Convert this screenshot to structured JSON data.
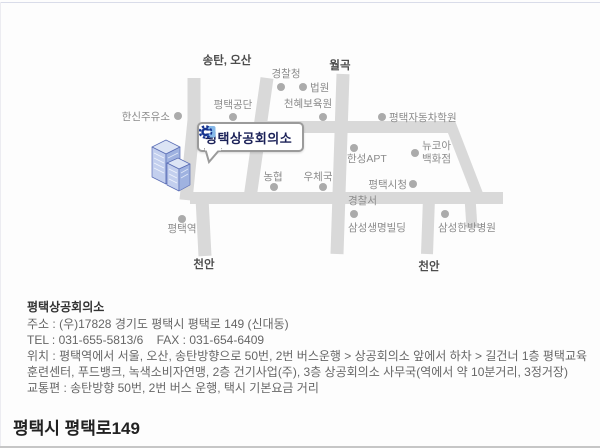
{
  "page": {
    "bottom_heading": "평택시 평택로149"
  },
  "map": {
    "callout_label": "평택상공회의소",
    "colors": {
      "road": "#d9d9d9",
      "dot": "#ababab",
      "place_label": "#8b8b8b",
      "direction_label": "#4d4d4d",
      "logo_navy": "#16338f",
      "logo_light_blue": "#85b8e8",
      "building_blue": "#9fb2e0"
    },
    "roads": [
      {
        "x1": 194,
        "y1": 78,
        "x2": 194,
        "y2": 122,
        "w": 13
      },
      {
        "x1": 194,
        "y1": 120,
        "x2": 186,
        "y2": 200,
        "w": 13
      },
      {
        "x1": 202,
        "y1": 198,
        "x2": 205,
        "y2": 256,
        "w": 13
      },
      {
        "x1": 267,
        "y1": 78,
        "x2": 250,
        "y2": 198,
        "w": 13
      },
      {
        "x1": 343,
        "y1": 74,
        "x2": 337,
        "y2": 254,
        "w": 13
      },
      {
        "x1": 256,
        "y1": 127,
        "x2": 452,
        "y2": 127,
        "w": 12
      },
      {
        "x1": 450,
        "y1": 123,
        "x2": 479,
        "y2": 198,
        "w": 11
      },
      {
        "x1": 470,
        "y1": 198,
        "x2": 472,
        "y2": 228,
        "w": 11
      },
      {
        "x1": 190,
        "y1": 198,
        "x2": 503,
        "y2": 198,
        "w": 12
      },
      {
        "x1": 429,
        "y1": 198,
        "x2": 427,
        "y2": 254,
        "w": 12
      }
    ],
    "places": [
      {
        "name": "hanshin-gas-station",
        "label": "한신주유소",
        "dot": [
          178,
          116
        ],
        "tx": 170,
        "ty": 120,
        "anchor": "end"
      },
      {
        "name": "pyeongtaek-industrial-complex",
        "label": "평택공단",
        "dot": [
          233,
          117
        ],
        "tx": 233,
        "ty": 108,
        "anchor": "middle"
      },
      {
        "name": "police-agency",
        "label": "경찰청",
        "dot": [
          281,
          87
        ],
        "tx": 286,
        "ty": 77,
        "anchor": "middle"
      },
      {
        "name": "court",
        "label": "법원",
        "dot": [
          303,
          87
        ],
        "tx": 310,
        "ty": 91,
        "anchor": "start"
      },
      {
        "name": "cheonhye-nursery",
        "label": "천혜보육원",
        "dot": [
          323,
          117
        ],
        "tx": 308,
        "ty": 107,
        "anchor": "middle"
      },
      {
        "name": "pyeongtaek-driving-school",
        "label": "평택자동차학원",
        "dot": [
          382,
          117
        ],
        "tx": 389,
        "ty": 121,
        "anchor": "start"
      },
      {
        "name": "newcore-department-store",
        "lines": [
          "뉴코아",
          "백화점"
        ],
        "dot": [
          415,
          153
        ],
        "tx": 422,
        "ty": 149,
        "anchor": "start"
      },
      {
        "name": "hanseong-apt",
        "label": "한성APT",
        "dot": [
          354,
          148
        ],
        "tx": 347,
        "ty": 162,
        "anchor": "start"
      },
      {
        "name": "pyeongtaek-city-hall",
        "label": "평택시청",
        "dot": [
          413,
          184
        ],
        "tx": 407,
        "ty": 188,
        "anchor": "end"
      },
      {
        "name": "nonghyup",
        "label": "농협",
        "dot": [
          274,
          187
        ],
        "tx": 273,
        "ty": 180,
        "anchor": "middle"
      },
      {
        "name": "post-office",
        "label": "우체국",
        "dot": [
          323,
          187
        ],
        "tx": 318,
        "ty": 180,
        "anchor": "middle"
      },
      {
        "name": "police-station",
        "label": "경찰서",
        "dot": null,
        "tx": 348,
        "ty": 204,
        "anchor": "start"
      },
      {
        "name": "samsung-life-building",
        "label": "삼성생명빌딩",
        "dot": [
          354,
          214
        ],
        "tx": 348,
        "ty": 231,
        "anchor": "start"
      },
      {
        "name": "samsung-oriental-hospital",
        "label": "삼성한방병원",
        "dot": [
          445,
          214
        ],
        "tx": 438,
        "ty": 231,
        "anchor": "start"
      },
      {
        "name": "pyeongtaek-station",
        "label": "평택역",
        "dot": [
          182,
          219
        ],
        "tx": 182,
        "ty": 232,
        "anchor": "middle"
      }
    ],
    "direction_labels": [
      {
        "name": "songtan-osan",
        "label": "송탄, 오산",
        "x": 227,
        "y": 64
      },
      {
        "name": "wolgok",
        "label": "월곡",
        "x": 340,
        "y": 69
      },
      {
        "name": "cheonan-left",
        "label": "천안",
        "x": 204,
        "y": 268
      },
      {
        "name": "cheonan-right",
        "label": "천안",
        "x": 429,
        "y": 270
      }
    ]
  },
  "info": {
    "title": "평택상공회의소",
    "lines": [
      "주소 : (우)17828 경기도 평택시 평택로 149 (신대동)",
      "TEL : 031-655-5813/6    FAX : 031-654-6409",
      "위치 : 평택역에서 서울, 오산, 송탄방향으로 50번, 2번 버스운행 > 상공회의소 앞에서 하차 > 길건너 1층 평택교육훈련센터, 푸드뱅크, 녹색소비자연맹, 2층 건기사업(주), 3층 상공회의소 사무국(역에서 약 10분거리, 3정거장)",
      "교통편 : 송탄방향 50번, 2번 버스 운행, 택시 기본요금 거리"
    ]
  }
}
